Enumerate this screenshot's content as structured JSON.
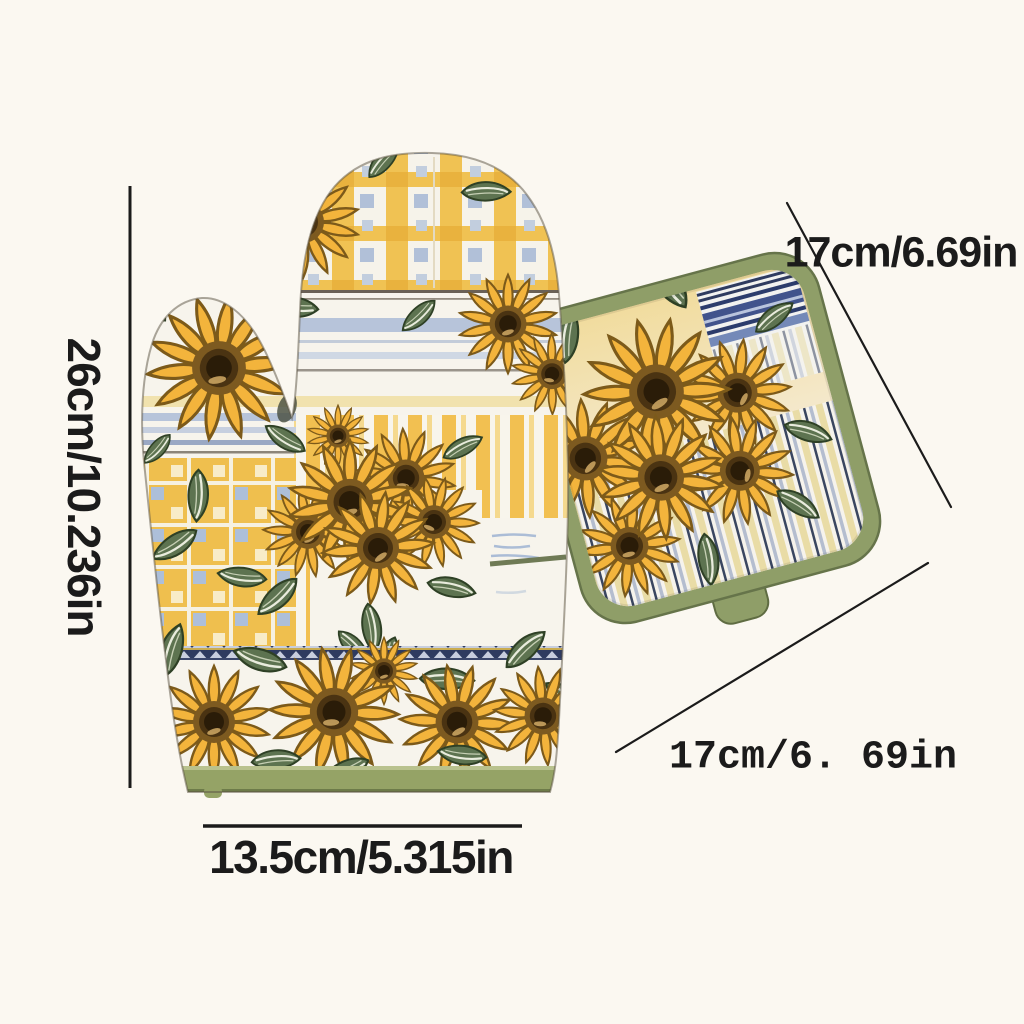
{
  "annotations": {
    "mitt_height": "26cm/10.236in",
    "mitt_width": "13.5cm/5.315in",
    "potholder_top": "17cm/6.69in",
    "potholder_bottom": "17cm/6. 69in"
  },
  "objects": {
    "left_item": "oven-mitt",
    "right_item": "pot-holder",
    "print_motif": "sunflowers"
  },
  "colors": {
    "bg": "#fbf8f1",
    "ink": "#1b1b1b",
    "petal": "#f3b43c",
    "petalline": "#7c5a1a",
    "sfring": "#7d5a20",
    "sfmid": "#4a3312",
    "sfcore": "#2a1c08",
    "leaf": "#5d7350",
    "leafdark": "#2e4025",
    "leafvein": "#e9ecdd",
    "trim": "#95a366",
    "trimdark": "#6d7b49",
    "plaidyellow": "#f0c253",
    "plaidblue": "#b1c0d8",
    "stripeyellow": "#f2c051",
    "stripelight": "#f5d98e",
    "checkblue": "#adbfd9",
    "hstripeblue": "#b7c4da",
    "navy": "#2f3b60",
    "potborder": "#8f9e68",
    "potbg1": "#f1dc9e",
    "pstripeblue": "#b4bdcf",
    "pstripeyellow": "#e9dca6",
    "fabric": "#f7f4ec"
  }
}
